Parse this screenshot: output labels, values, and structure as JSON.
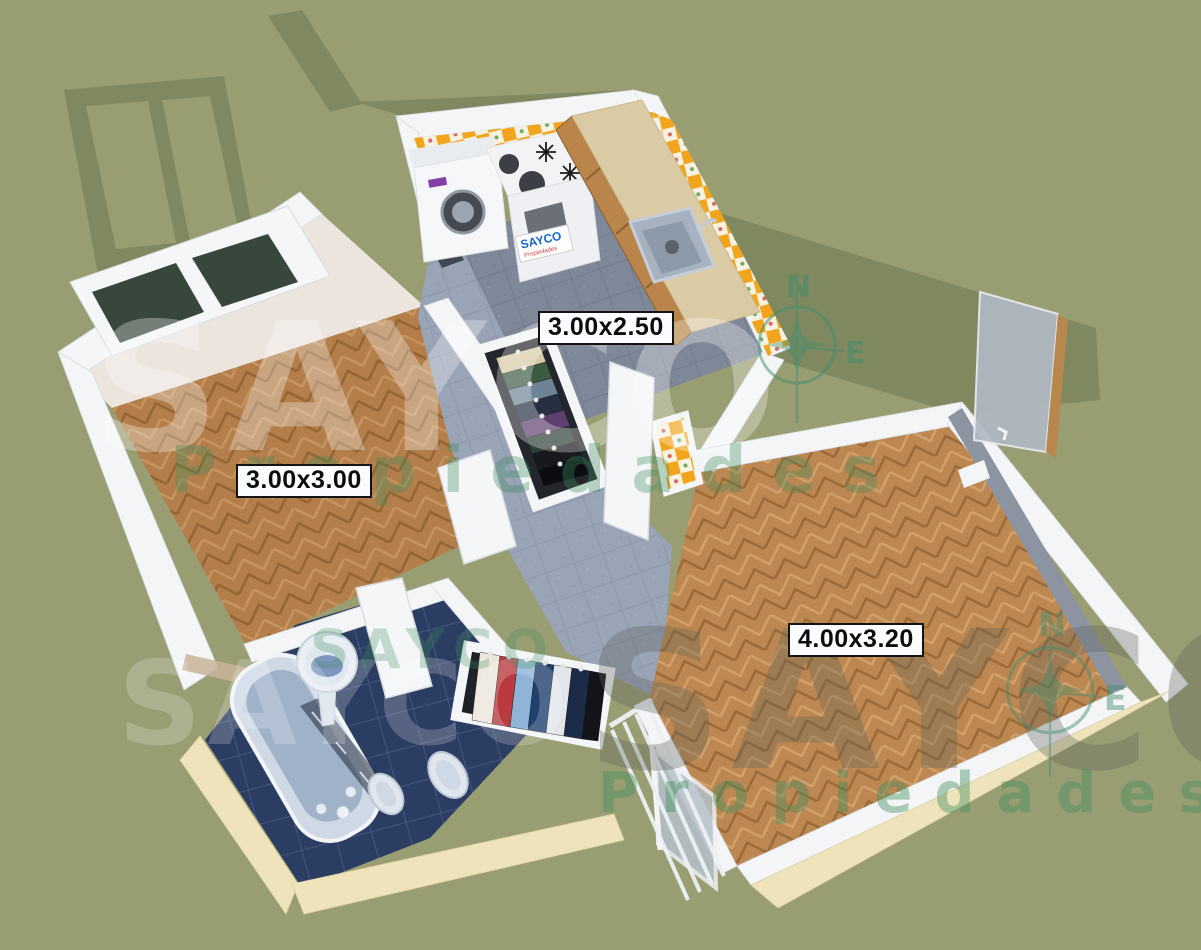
{
  "scene": {
    "description": "3D isometric real-estate render of a 2-room apartment floor plan",
    "background_color": "#999d72",
    "shadow_color": "#7f885f"
  },
  "labels": {
    "bedroom": "3.00x3.00",
    "kitchen": "3.00x2.50",
    "living": "4.00x3.20"
  },
  "watermark": {
    "brand": "SAYCO",
    "subtitle": "Propiedades",
    "compass_north": "N",
    "compass_east": "E"
  },
  "appliance_logo": {
    "brand": "SAYCO",
    "subtitle": "Propiedades"
  },
  "rooms": {
    "bedroom": {
      "label": "3.00x3.00",
      "floor": "herringbone parquet"
    },
    "kitchen": {
      "label": "3.00x2.50",
      "floor": "gray tile",
      "walls": "orange-white checker tile"
    },
    "living": {
      "label": "4.00x3.20",
      "floor": "herringbone parquet"
    },
    "bathroom": {
      "floor": "navy blue tile",
      "fixtures": [
        "bathtub",
        "pedestal sink",
        "bidet",
        "toilet"
      ]
    },
    "hallway": {
      "floor": "blue-gray tile",
      "fixtures": [
        "wardrobe with clothes",
        "wardrobe with clothes"
      ]
    }
  },
  "colors": {
    "wall": "#f3f5f7",
    "outer_wall": "#efe3bb",
    "parquet": "#bd8751",
    "bathroom_tile": "#2c3d63",
    "hall_tile": "#99a4b7",
    "kitchen_tile": "#7f8898",
    "checker_orange": "#f2a51c",
    "counter": "#dbcba4",
    "cabinet_wood": "#b9854a",
    "fixture": "#cfd9e6",
    "window_glass": "#37473c",
    "watermark_green": "#3f8f5f"
  }
}
